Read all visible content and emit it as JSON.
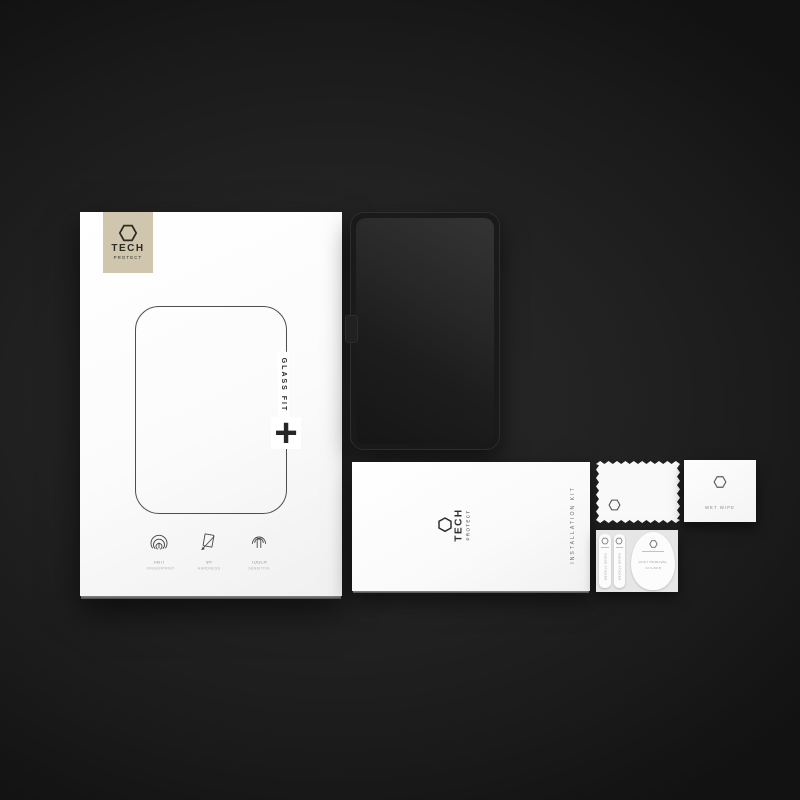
{
  "colors": {
    "background": "#1e1e1e",
    "logo_square": "#cfc6ad",
    "box_white": "#fbfbfb",
    "ink_dark": "#2b2b2b",
    "muted_gray": "#8d8d8d"
  },
  "brand": {
    "word1": "TECH",
    "word2": "PROTECT",
    "logo_icon": "hexagon-icon"
  },
  "box": {
    "product_line_label": "GLASS FIT",
    "plus_symbol": "+",
    "features": [
      {
        "icon": "fingerprint-icon",
        "line1": "ANTI",
        "line2": "FINGERPRINT"
      },
      {
        "icon": "hardness-icon",
        "line1": "9H",
        "line2": "HARDNESS"
      },
      {
        "icon": "touch-icon",
        "line1": "TOUCH",
        "line2": "SENSITIVE"
      }
    ]
  },
  "envelope": {
    "side_label": "INSTALLATION KIT"
  },
  "wet_wipe_packet": {
    "label": "WET WIPE"
  },
  "sticker_sheet": {
    "strips": [
      {
        "label": "GUIDE STICKER"
      },
      {
        "label": "GUIDE STICKER"
      }
    ],
    "dust_sticker": {
      "line1": "DUST REMOVAL",
      "line2": "STICKER"
    }
  }
}
